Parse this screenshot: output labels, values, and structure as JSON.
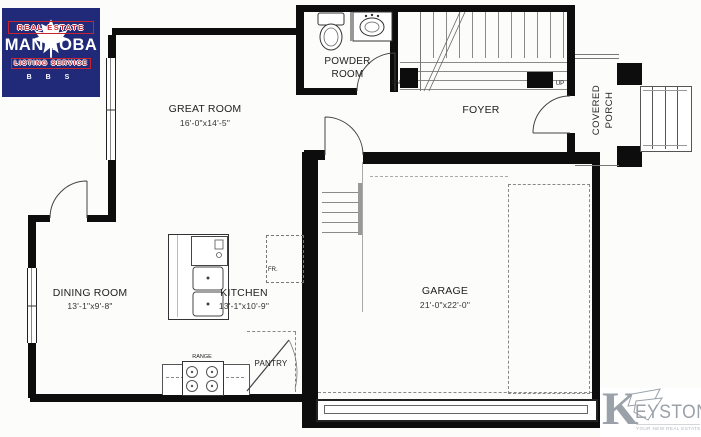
{
  "logo_mls": {
    "real_estate": "REAL ESTATE",
    "manitoba": "MANITOBA",
    "listing_service": "LISTING SERVICE",
    "bbs": "B B S"
  },
  "logo_keystone": {
    "initial": "K",
    "name_rest": "EYSTONE",
    "tagline": "YOUR NEW REAL ESTATE RESOURCE"
  },
  "rooms": {
    "great_room": {
      "name": "GREAT ROOM",
      "dims": "16'-0\"x14'-5\""
    },
    "powder_room": {
      "line1": "POWDER",
      "line2": "ROOM"
    },
    "foyer": {
      "name": "FOYER"
    },
    "covered_porch": {
      "line1": "COVERED",
      "line2": "PORCH"
    },
    "garage": {
      "name": "GARAGE",
      "dims": "21'-0\"x22'-0\""
    },
    "dining_room": {
      "name": "DINING ROOM",
      "dims": "13'-1\"x9'-8\""
    },
    "kitchen": {
      "name": "KITCHEN",
      "dims": "13'-1\"x10'-9\""
    },
    "pantry": {
      "name": "PANTRY"
    }
  },
  "labels": {
    "range": "RANGE",
    "fridge": "FR.",
    "up": "UP",
    "down": "DN"
  },
  "colors": {
    "wall": "#0d0d0d",
    "mls_blue": "#202a78",
    "mls_red": "#c8242f",
    "keystone_gray": "#9aa1a8"
  }
}
